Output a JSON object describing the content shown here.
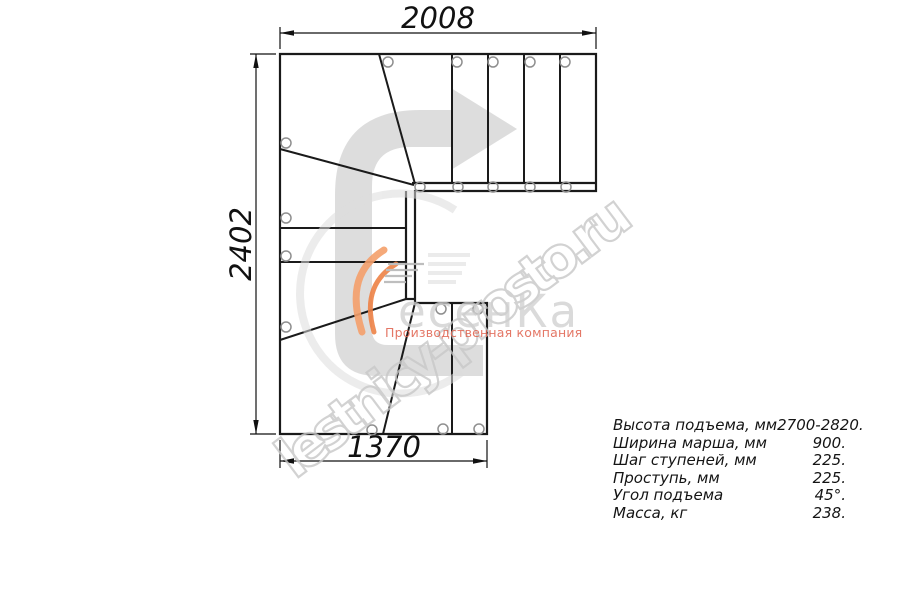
{
  "dimensions": {
    "top": "2008",
    "left": "2402",
    "bottom": "1370"
  },
  "specs": [
    {
      "label": "Высота подъема, мм",
      "value": "2700-2820."
    },
    {
      "label": "Ширина марша, мм",
      "value": "900."
    },
    {
      "label": "Шаг ступеней, мм",
      "value": "225."
    },
    {
      "label": "Проступь, мм",
      "value": "225."
    },
    {
      "label": "Угол подъема",
      "value": "45°."
    },
    {
      "label": "Масса, кг",
      "value": "238."
    }
  ],
  "watermark": {
    "site": "lestnicy-prosto.ru",
    "brand": "есенКа",
    "subtitle": "Производственная компания"
  },
  "colors": {
    "line": "#1a1a1a",
    "hole_stroke": "#8f8f8f",
    "direction_arrow": "#dadada",
    "flame_light": "#f5a06b",
    "flame_dark": "#ee8246",
    "brand_gray": "#cfcfcf",
    "subtitle_red": "#e0604c",
    "watermark_gray": "#c8c8c8"
  }
}
